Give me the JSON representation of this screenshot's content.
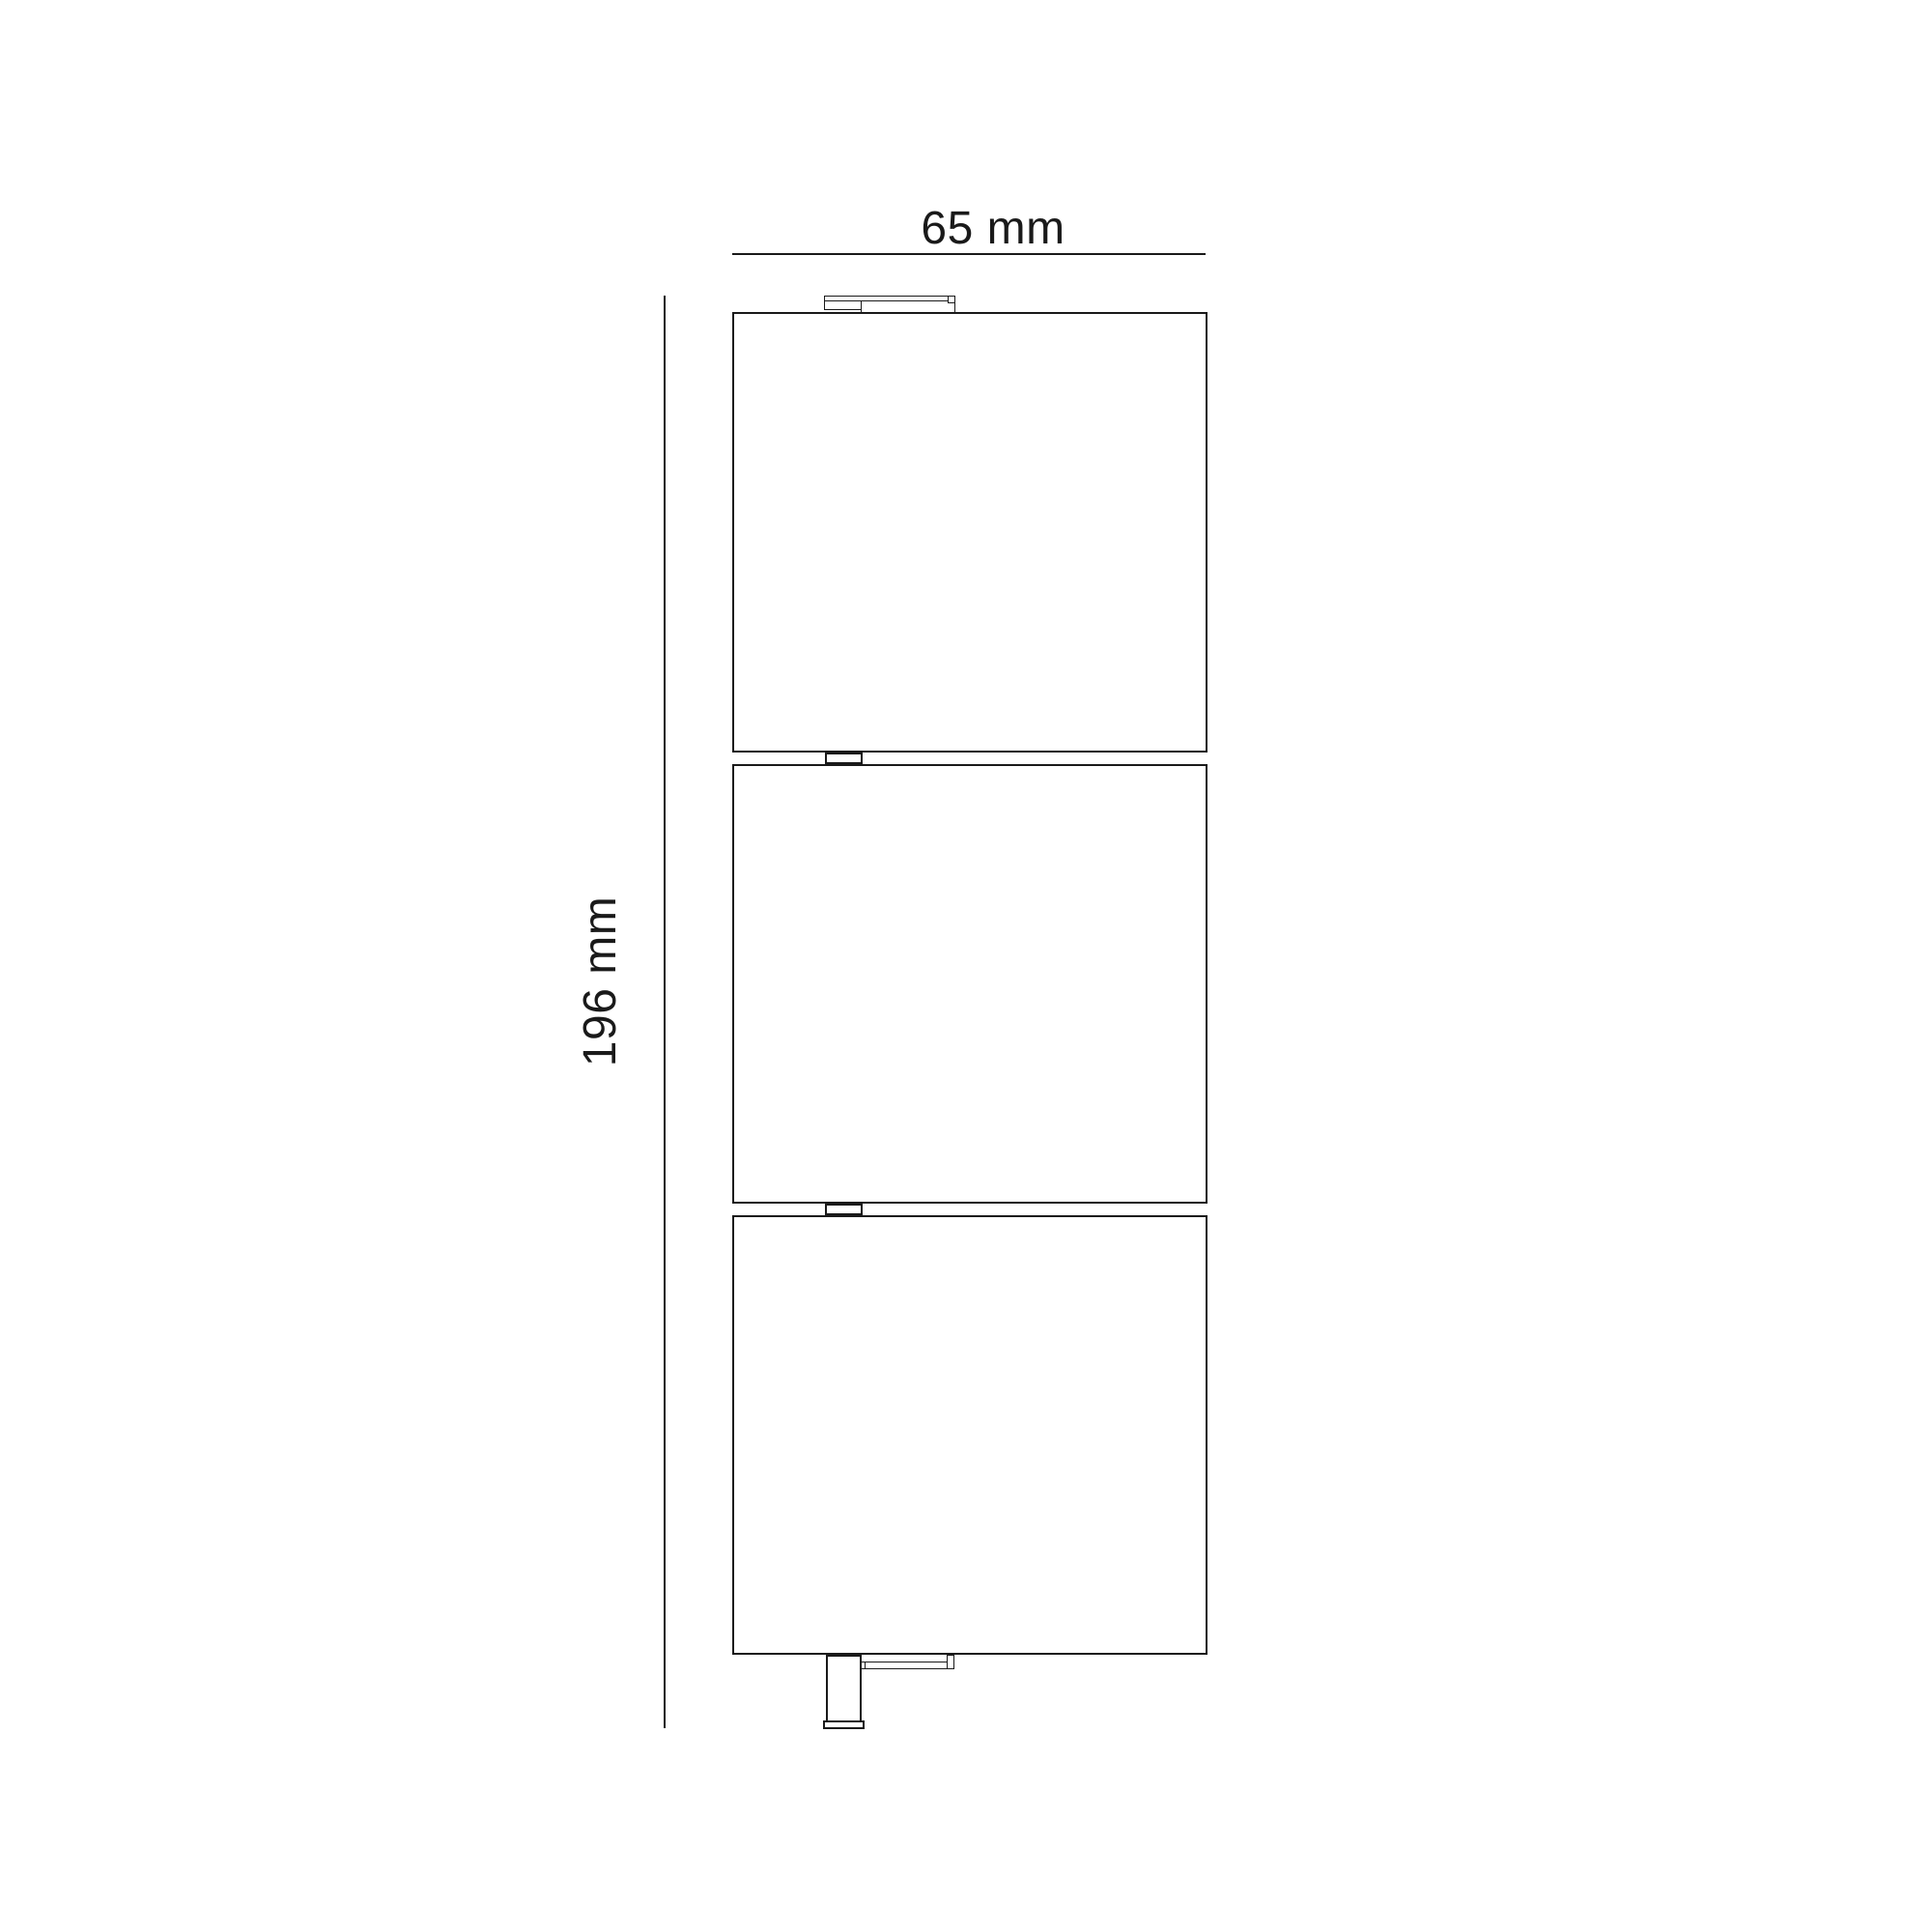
{
  "drawing": {
    "kind": "technical dimension drawing",
    "dimensions": {
      "width_label": "65 mm",
      "height_label": "196 mm"
    },
    "style": {
      "line_color": "#1a1a1a",
      "background_color": "#ffffff"
    }
  }
}
